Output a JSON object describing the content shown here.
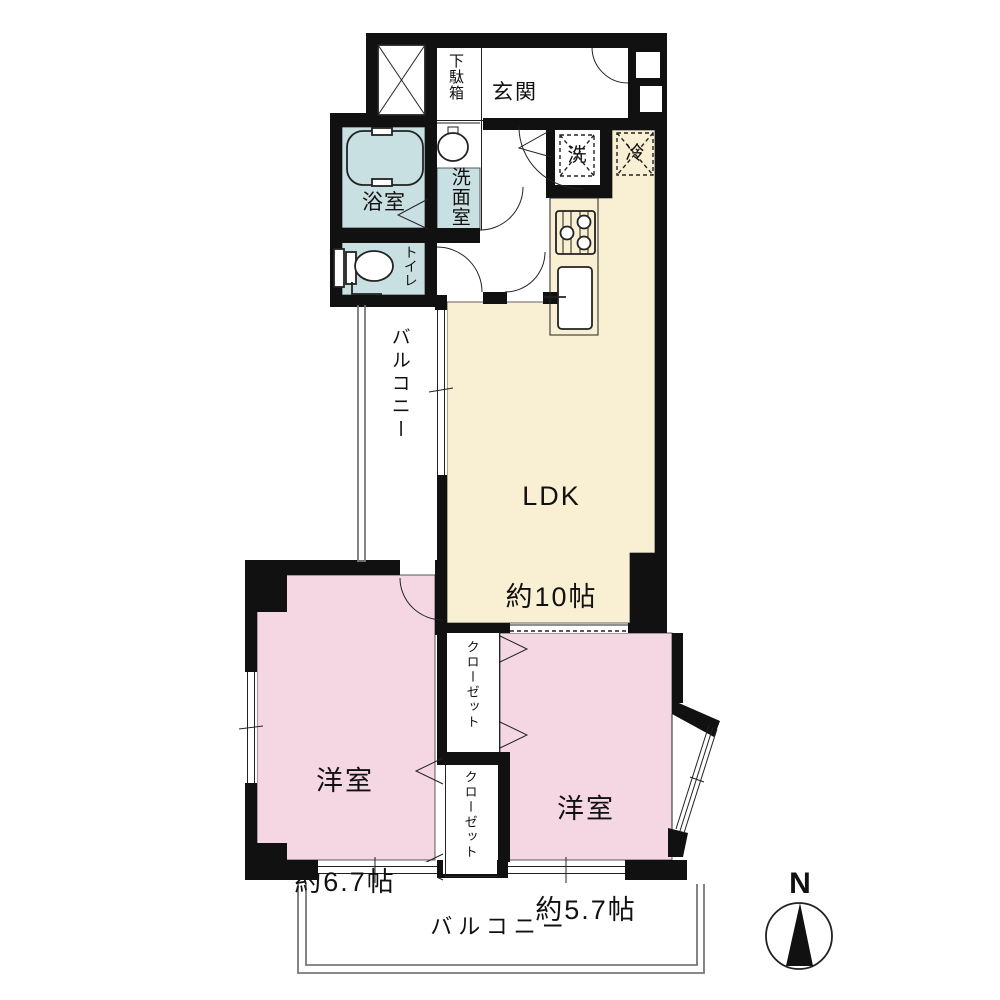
{
  "floor_plan": {
    "rooms": {
      "entrance": "玄関",
      "shoe_cabinet": "下駄箱",
      "bathroom": "浴室",
      "washroom": "洗面室",
      "toilet": "トイレ",
      "ldk": {
        "name": "LDK",
        "size": "約10帖"
      },
      "bedroom1": {
        "name": "洋室",
        "size": "約6.7帖"
      },
      "bedroom2": {
        "name": "洋室",
        "size": "約5.7帖"
      },
      "closet1": "クローゼット",
      "closet2": "クローゼット",
      "balcony_side": "バルコニー",
      "balcony_bottom": "バルコニー"
    },
    "appliances": {
      "washer": "洗",
      "fridge": "冷"
    },
    "compass": {
      "label": "N"
    },
    "colors": {
      "wall": "#111111",
      "wet_area": "#c9e0e2",
      "ldk": "#f9efd2",
      "bedroom": "#f5d7e3",
      "railing": "#777777"
    }
  }
}
